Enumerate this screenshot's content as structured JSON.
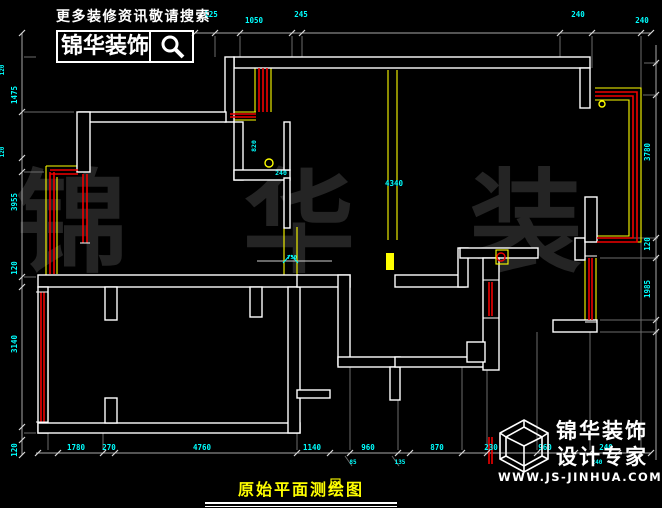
{
  "branding": {
    "slogan": "更多装修资讯敬请搜索",
    "logo_text": "锦华装饰",
    "search_icon": "magnifier",
    "footer_line1": "锦华装饰",
    "footer_line2": "设计专家",
    "website": "WWW.JS-JINHUA.COM",
    "watermark": "锦 华 装 饰",
    "title": "原始平面测绘图"
  },
  "colors": {
    "background": "#000000",
    "wall": "#ffffff",
    "window_red": "#f00000",
    "accent_yellow": "#ffff00",
    "dimension_cyan": "#00ffff",
    "title_yellow": "#ffff00",
    "watermark_gray": "#242424"
  },
  "drawing": {
    "dim_lines": [
      [
        195,
        33,
        651,
        33
      ],
      [
        36,
        453,
        651,
        453
      ],
      [
        22,
        33,
        22,
        455
      ],
      [
        656,
        45,
        656,
        460
      ]
    ],
    "ext_lines": [
      [
        215,
        36,
        215,
        57
      ],
      [
        240,
        36,
        240,
        57
      ],
      [
        292,
        36,
        292,
        58
      ],
      [
        302,
        36,
        302,
        58
      ],
      [
        560,
        36,
        560,
        57
      ],
      [
        592,
        36,
        592,
        68
      ],
      [
        641,
        36,
        641,
        90
      ],
      [
        48,
        433,
        48,
        450
      ],
      [
        103,
        433,
        103,
        450
      ],
      [
        297,
        433,
        297,
        450
      ],
      [
        350,
        367,
        350,
        450
      ],
      [
        398,
        400,
        398,
        450
      ],
      [
        462,
        367,
        462,
        450
      ],
      [
        487,
        370,
        487,
        450
      ],
      [
        537,
        332,
        537,
        450
      ],
      [
        590,
        332,
        590,
        450
      ],
      [
        641,
        242,
        641,
        450
      ],
      [
        24,
        57,
        36,
        57
      ],
      [
        24,
        112,
        74,
        112
      ],
      [
        24,
        172,
        44,
        172
      ],
      [
        24,
        277,
        36,
        277
      ],
      [
        24,
        433,
        36,
        433
      ],
      [
        644,
        63,
        658,
        63
      ],
      [
        643,
        95,
        658,
        95
      ],
      [
        600,
        238,
        658,
        238
      ],
      [
        600,
        258,
        658,
        258
      ],
      [
        600,
        320,
        658,
        320
      ],
      [
        600,
        332,
        658,
        332
      ],
      [
        345,
        456,
        352,
        466
      ],
      [
        392,
        456,
        399,
        466
      ]
    ],
    "thin_lines": [
      [
        257,
        261,
        332,
        261
      ]
    ],
    "walls": [
      [
        234,
        57,
        356,
        11
      ],
      [
        225,
        57,
        9,
        65
      ],
      [
        580,
        68,
        10,
        40
      ],
      [
        79,
        112,
        147,
        10
      ],
      [
        77,
        112,
        13,
        60
      ],
      [
        38,
        275,
        260,
        12
      ],
      [
        105,
        287,
        12,
        33
      ],
      [
        250,
        287,
        12,
        30
      ],
      [
        38,
        287,
        10,
        146
      ],
      [
        38,
        423,
        262,
        10
      ],
      [
        105,
        398,
        12,
        25
      ],
      [
        288,
        287,
        12,
        146
      ],
      [
        234,
        122,
        9,
        58
      ],
      [
        234,
        170,
        56,
        10
      ],
      [
        284,
        122,
        6,
        48
      ],
      [
        284,
        178,
        6,
        50
      ],
      [
        297,
        275,
        53,
        12
      ],
      [
        395,
        275,
        70,
        12
      ],
      [
        458,
        248,
        10,
        39
      ],
      [
        460,
        248,
        78,
        10
      ],
      [
        338,
        275,
        12,
        90
      ],
      [
        338,
        357,
        62,
        10
      ],
      [
        390,
        367,
        10,
        33
      ],
      [
        395,
        357,
        92,
        10
      ],
      [
        483,
        258,
        16,
        112
      ],
      [
        467,
        342,
        18,
        20
      ],
      [
        297,
        390,
        33,
        8
      ],
      [
        553,
        320,
        44,
        12
      ],
      [
        575,
        238,
        10,
        22
      ],
      [
        585,
        197,
        12,
        45
      ]
    ],
    "red_lines": [
      [
        50,
        172,
        50,
        274
      ],
      [
        54,
        172,
        54,
        274
      ],
      [
        50,
        170,
        78,
        170
      ],
      [
        50,
        174,
        78,
        174
      ],
      [
        83,
        174,
        83,
        243
      ],
      [
        87,
        174,
        87,
        243
      ],
      [
        41,
        292,
        41,
        422
      ],
      [
        44,
        292,
        44,
        422
      ],
      [
        259,
        68,
        259,
        112
      ],
      [
        263,
        68,
        263,
        112
      ],
      [
        267,
        68,
        267,
        112
      ],
      [
        230,
        114,
        256,
        114
      ],
      [
        230,
        117,
        256,
        117
      ],
      [
        589,
        258,
        589,
        320
      ],
      [
        592,
        258,
        592,
        320
      ],
      [
        489,
        282,
        489,
        316
      ],
      [
        492,
        282,
        492,
        316
      ],
      [
        489,
        437,
        489,
        464
      ],
      [
        492,
        437,
        492,
        464
      ]
    ],
    "red_polylines": [
      [
        [
          595,
          92
        ],
        [
          637,
          92
        ],
        [
          637,
          242
        ],
        [
          597,
          242
        ]
      ],
      [
        [
          595,
          96
        ],
        [
          633,
          96
        ],
        [
          633,
          238
        ],
        [
          597,
          238
        ]
      ]
    ],
    "yellow_lines": [
      [
        46,
        166,
        46,
        277
      ],
      [
        57,
        177,
        57,
        274
      ],
      [
        46,
        166,
        80,
        166
      ],
      [
        48,
        292,
        48,
        422
      ],
      [
        255,
        68,
        255,
        112
      ],
      [
        271,
        68,
        271,
        112
      ],
      [
        230,
        112,
        256,
        112
      ],
      [
        230,
        120,
        256,
        120
      ],
      [
        388,
        70,
        388,
        240
      ],
      [
        397,
        70,
        397,
        240
      ],
      [
        284,
        227,
        284,
        283
      ],
      [
        297,
        227,
        297,
        283
      ],
      [
        585,
        258,
        585,
        320
      ],
      [
        596,
        258,
        596,
        320
      ],
      [
        486,
        280,
        486,
        318
      ],
      [
        496,
        280,
        496,
        318
      ],
      [
        486,
        280,
        496,
        280
      ],
      [
        486,
        318,
        496,
        318
      ]
    ],
    "yellow_polylines": [
      [
        [
          595,
          88
        ],
        [
          641,
          88
        ],
        [
          641,
          242
        ],
        [
          597,
          242
        ]
      ],
      [
        [
          595,
          100
        ],
        [
          629,
          100
        ],
        [
          629,
          236
        ],
        [
          597,
          236
        ]
      ]
    ],
    "yellow_filled_rects": [
      [
        386,
        253,
        8,
        17
      ]
    ],
    "yellow_outline_rects": [
      [
        496,
        250,
        12,
        14
      ],
      [
        331,
        479,
        9,
        9
      ]
    ],
    "yellow_circles": [
      [
        269,
        163,
        4
      ],
      [
        602,
        104,
        3
      ],
      [
        335,
        483,
        1.5
      ]
    ],
    "red_circles": [
      [
        501,
        257,
        4
      ]
    ],
    "white_ticks": [
      [
        80,
        172,
        90,
        172
      ],
      [
        80,
        243,
        90,
        243
      ],
      [
        36,
        292,
        48,
        292
      ],
      [
        36,
        422,
        48,
        422
      ],
      [
        585,
        256,
        597,
        256
      ],
      [
        585,
        322,
        597,
        322
      ],
      [
        483,
        280,
        499,
        280
      ],
      [
        483,
        318,
        499,
        318
      ]
    ],
    "cyan_leaders": [
      [
        283,
        263,
        290,
        255
      ],
      [
        298,
        263,
        291,
        255
      ]
    ],
    "ticks": {
      "top": {
        "y": 33,
        "xs": [
          195,
          215,
          240,
          292,
          302,
          560,
          592,
          641,
          651
        ]
      },
      "bottom": {
        "y": 453,
        "xs": [
          38,
          58,
          103,
          115,
          297,
          330,
          350,
          398,
          410,
          462,
          487,
          537,
          575,
          590,
          618,
          641,
          651
        ]
      },
      "left": {
        "x": 22,
        "ys": [
          33,
          112,
          158,
          172,
          277,
          287,
          427,
          440,
          455
        ]
      },
      "right": {
        "x": 656,
        "ys": [
          63,
          95,
          238,
          258,
          320,
          332
        ]
      }
    },
    "labels": [
      {
        "t": "125",
        "x": 211,
        "y": 17
      },
      {
        "t": "1050",
        "x": 254,
        "y": 23
      },
      {
        "t": "245",
        "x": 301,
        "y": 17
      },
      {
        "t": "240",
        "x": 578,
        "y": 17
      },
      {
        "t": "240",
        "x": 642,
        "y": 23
      },
      {
        "t": "1780",
        "x": 76,
        "y": 450
      },
      {
        "t": "270",
        "x": 109,
        "y": 450
      },
      {
        "t": "4760",
        "x": 202,
        "y": 450
      },
      {
        "t": "1140",
        "x": 312,
        "y": 450
      },
      {
        "t": "960",
        "x": 368,
        "y": 450
      },
      {
        "t": "870",
        "x": 437,
        "y": 450
      },
      {
        "t": "230",
        "x": 491,
        "y": 450
      },
      {
        "t": "960",
        "x": 545,
        "y": 450
      },
      {
        "t": "240",
        "x": 606,
        "y": 450
      },
      {
        "t": "85",
        "x": 353,
        "y": 464,
        "s": 6
      },
      {
        "t": "135",
        "x": 400,
        "y": 464,
        "s": 6
      },
      {
        "t": "240",
        "x": 597,
        "y": 464,
        "s": 6
      },
      {
        "t": "1475",
        "x": 17,
        "y": 95,
        "r": -90
      },
      {
        "t": "3955",
        "x": 17,
        "y": 202,
        "r": -90
      },
      {
        "t": "120",
        "x": 17,
        "y": 268,
        "r": -90
      },
      {
        "t": "3140",
        "x": 17,
        "y": 344,
        "r": -90
      },
      {
        "t": "120",
        "x": 17,
        "y": 450,
        "r": -90
      },
      {
        "t": "120",
        "x": 4,
        "y": 70,
        "r": -90,
        "s": 6
      },
      {
        "t": "120",
        "x": 4,
        "y": 152,
        "r": -90,
        "s": 6
      },
      {
        "t": "3780",
        "x": 650,
        "y": 152,
        "r": -90
      },
      {
        "t": "120",
        "x": 650,
        "y": 244,
        "r": -90
      },
      {
        "t": "1985",
        "x": 650,
        "y": 289,
        "r": -90
      },
      {
        "t": "820",
        "x": 256,
        "y": 146,
        "r": -90,
        "s": 6.5
      },
      {
        "t": "240",
        "x": 281,
        "y": 175,
        "s": 6.5
      },
      {
        "t": "4340",
        "x": 394,
        "y": 186
      },
      {
        "t": "750",
        "x": 292,
        "y": 259,
        "s": 5.5
      }
    ]
  }
}
